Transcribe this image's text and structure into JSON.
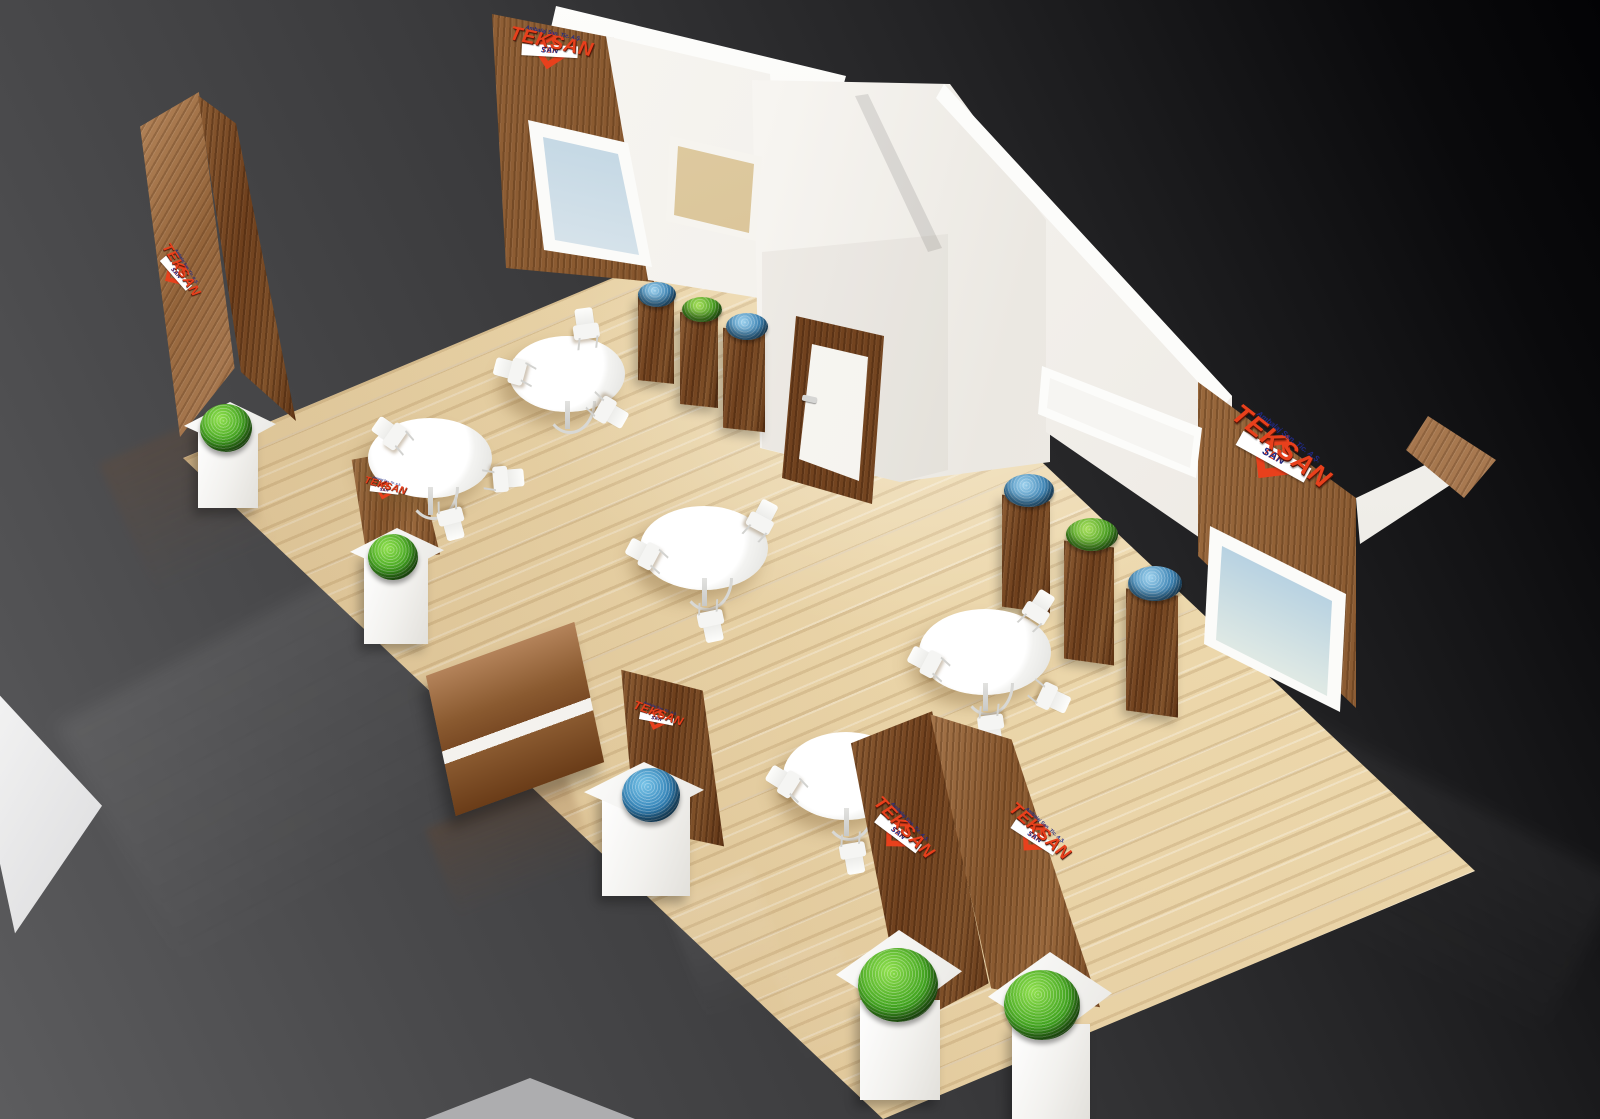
{
  "branding": {
    "logo": {
      "word": "TEKSAN",
      "tek": "TEK",
      "san": "SAN",
      "subtitle": "Ambalaj San. Tic. A.Ş."
    },
    "colors": {
      "logo_red": "#e8401c",
      "logo_navy": "#202a84",
      "wood": "#8a5a33",
      "floor_wood": "#ead5ab",
      "wall_white": "#f5f3ef",
      "backdrop_dark": "#0a0a0c",
      "backdrop_gray": "#4e4e50",
      "ball_green": "#3fa21e",
      "ball_blue": "#2f7fb5"
    }
  },
  "inventory": {
    "round_tables": 5,
    "chairs": 16,
    "branded_wood_towers": 3,
    "branded_wood_panels": 3,
    "wood_display_pedestals": 6,
    "white_display_pedestals": 5,
    "decor_bowls": [
      "blue",
      "green",
      "blue",
      "blue",
      "green",
      "blue"
    ],
    "decor_balls": [
      "green",
      "green",
      "blue",
      "green",
      "green"
    ],
    "wall_pictures": [
      "ship-photo",
      "sand-photo",
      "colorful-art",
      "ship-photo"
    ],
    "doors": 1,
    "logo_instances": 7
  }
}
